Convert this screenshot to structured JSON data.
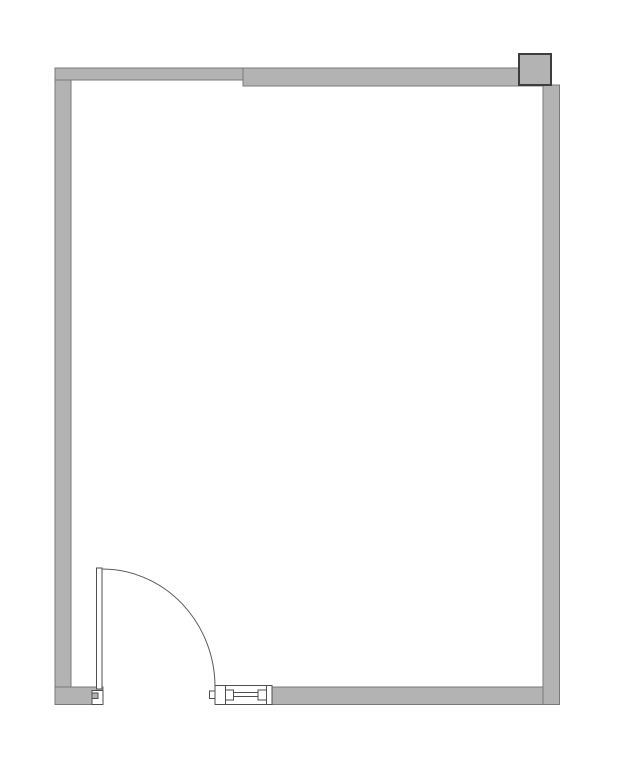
{
  "floorplan": {
    "title": "Room floor plan with door, window opening and corner column",
    "canvas": {
      "width": 638,
      "height": 768,
      "background": "#ffffff"
    },
    "colors": {
      "wall_fill": "#b3b3b3",
      "wall_stroke": "#787878",
      "detail_stroke": "#4f4f4f",
      "column_stroke": "#3d3d3d",
      "opening_fill": "#ffffff"
    },
    "shapes": [
      {
        "name": "wall-bottom",
        "type": "rect",
        "x": 272,
        "y": 687,
        "w": 287.5,
        "h": 17.5
      },
      {
        "name": "wall-right",
        "type": "rect",
        "x": 543,
        "y": 85,
        "w": 16.5,
        "h": 619.5
      },
      {
        "name": "wall-left",
        "type": "rect",
        "x": 55,
        "y": 68,
        "w": 16,
        "h": 636.5
      },
      {
        "name": "wall-top-thin",
        "type": "rect",
        "x": 55,
        "y": 68,
        "w": 188,
        "h": 12
      },
      {
        "name": "wall-top-thick",
        "type": "rect",
        "x": 243,
        "y": 68,
        "w": 300,
        "h": 18
      },
      {
        "name": "wall-bottom-door-stub",
        "type": "rect",
        "x": 55,
        "y": 687,
        "w": 48,
        "h": 17.5
      },
      {
        "name": "door-jamb-notch",
        "type": "rect",
        "x": 92,
        "y": 690.5,
        "w": 11,
        "h": 14,
        "fill": "#ffffff",
        "stroke": "#4f4f4f"
      },
      {
        "name": "door-jamb-stop",
        "type": "rect",
        "x": 92,
        "y": 693,
        "w": 6,
        "h": 5.5,
        "stroke": "#4f4f4f"
      },
      {
        "name": "column",
        "type": "rect",
        "x": 519,
        "y": 54,
        "w": 32,
        "h": 31,
        "stroke": "#3d3d3d",
        "sw": 2
      },
      {
        "name": "door-leaf",
        "type": "rect",
        "x": 96.5,
        "y": 568,
        "w": 5.5,
        "h": 121,
        "fill": "#ffffff",
        "stroke": "#4f4f4f"
      },
      {
        "name": "door-swing-arc",
        "type": "path",
        "d": "M 102 569 A 113 118 0 0 1 215 687",
        "fill": "none",
        "stroke": "#5a5a5a"
      },
      {
        "name": "window-frame",
        "type": "rect",
        "x": 215,
        "y": 685.5,
        "w": 57,
        "h": 19,
        "fill": "#ffffff",
        "stroke": "#4f4f4f"
      },
      {
        "name": "window-left-nub",
        "type": "rect",
        "x": 209.5,
        "y": 691,
        "w": 5.5,
        "h": 7.5,
        "fill": "#ffffff",
        "stroke": "#4f4f4f"
      },
      {
        "name": "window-divider-left",
        "type": "line",
        "x1": 225.5,
        "y1": 685.5,
        "x2": 225.5,
        "y2": 704.5,
        "stroke": "#4f4f4f"
      },
      {
        "name": "window-divider-right",
        "type": "line",
        "x1": 266.5,
        "y1": 685.5,
        "x2": 266.5,
        "y2": 704.5,
        "stroke": "#4f4f4f"
      },
      {
        "name": "window-sash-left",
        "type": "rect",
        "x": 225.5,
        "y": 690,
        "w": 8,
        "h": 10,
        "fill": "#ffffff",
        "stroke": "#4f4f4f"
      },
      {
        "name": "window-sash-right",
        "type": "rect",
        "x": 258,
        "y": 690,
        "w": 8.5,
        "h": 10,
        "fill": "#ffffff",
        "stroke": "#4f4f4f"
      },
      {
        "name": "window-rail-top",
        "type": "line",
        "x1": 233.5,
        "y1": 692.5,
        "x2": 258,
        "y2": 692.5,
        "stroke": "#4f4f4f"
      },
      {
        "name": "window-rail-bottom",
        "type": "line",
        "x1": 233.5,
        "y1": 696.5,
        "x2": 258,
        "y2": 696.5,
        "stroke": "#4f4f4f"
      }
    ]
  }
}
